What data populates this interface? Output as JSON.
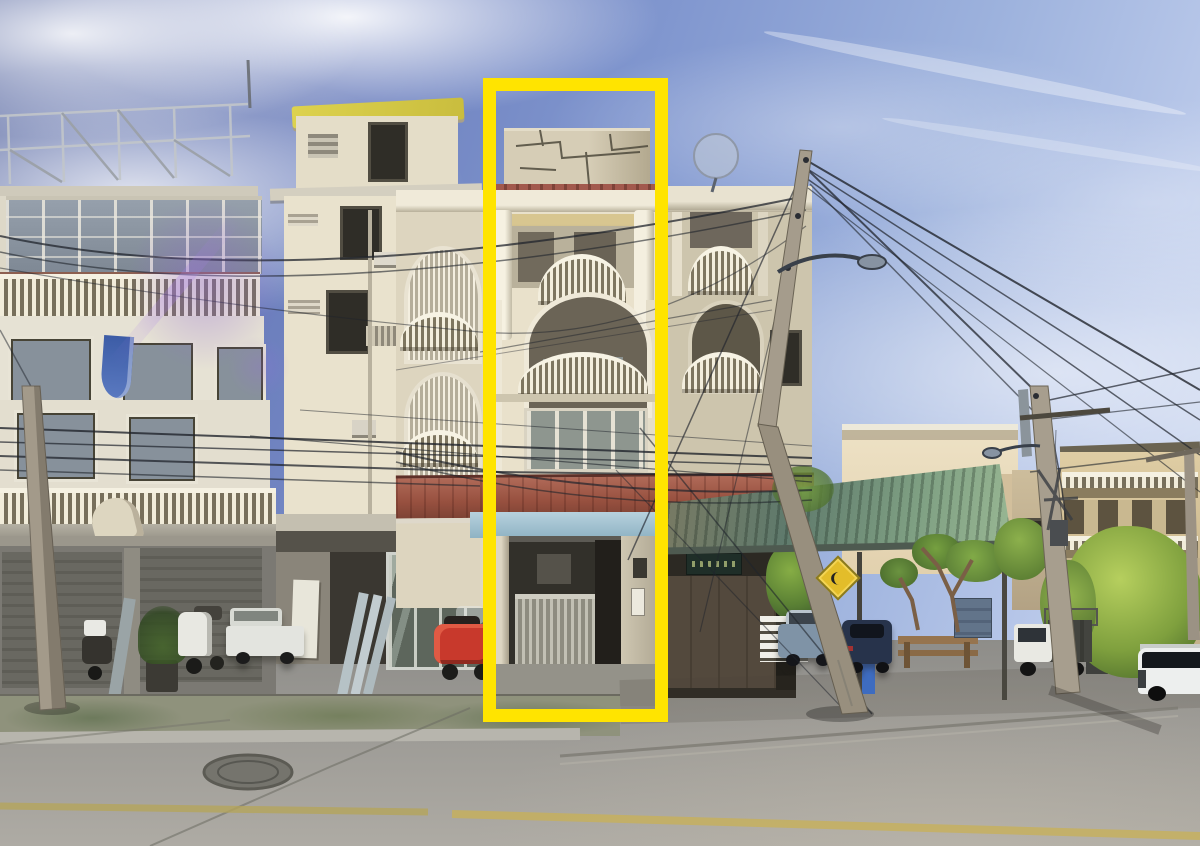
{
  "scene": {
    "type": "street-photograph",
    "description": "Sunny street-view photo of a row of Thai shophouse buildings; one ornate cream shophouse unit with arched balconies is outlined by a tall yellow annotation rectangle. Tangled power lines, tilted utility poles, parked cars, scooters and a concrete road in the foreground.",
    "width": 1200,
    "height": 846
  },
  "annotation": {
    "label": "highlighted-shophouse-unit",
    "x": 483,
    "y": 78,
    "width": 185,
    "height": 644,
    "border_px": 13,
    "color": "#ffe400"
  },
  "palette": {
    "sky_deep": "#55659f",
    "sky_light": "#cfdaf0",
    "building_cream": "#e7dfc9",
    "building_shade": "#c6bfa9",
    "tile_awning_red": "#9a5546",
    "fascia_blue": "#a8c6d6",
    "corrugated_awning_green": "#5f7a6e",
    "road_gray": "#9a9894",
    "annotation_yellow": "#ffe400",
    "wire_dark": "#20242c",
    "foliage_green": "#6f8f3f"
  },
  "objects": [
    "left-shophouse-with-roller-shutters",
    "cream-tower-with-yellow-roof-penthouse",
    "highlighted-ornate-shophouse",
    "shaded-ornate-shophouse",
    "rooftop-steel-frame",
    "cracked-rooftop-wall",
    "satellite-dish",
    "red-tile-awning",
    "corrugated-metal-awning",
    "utility-poles-with-power-lines",
    "street-lamp",
    "warning-road-sign",
    "white-scooter",
    "dark-scooter",
    "red-scooter",
    "white-pickup",
    "blue-sedan",
    "navy-hatchback",
    "white-truck",
    "white-suv",
    "trash-bin",
    "wooden-bench",
    "white-fence",
    "frangipani-trees",
    "large-green-tree",
    "manhole-cover",
    "faded-yellow-road-line",
    "mossy-sidewalk",
    "lens-flare"
  ]
}
